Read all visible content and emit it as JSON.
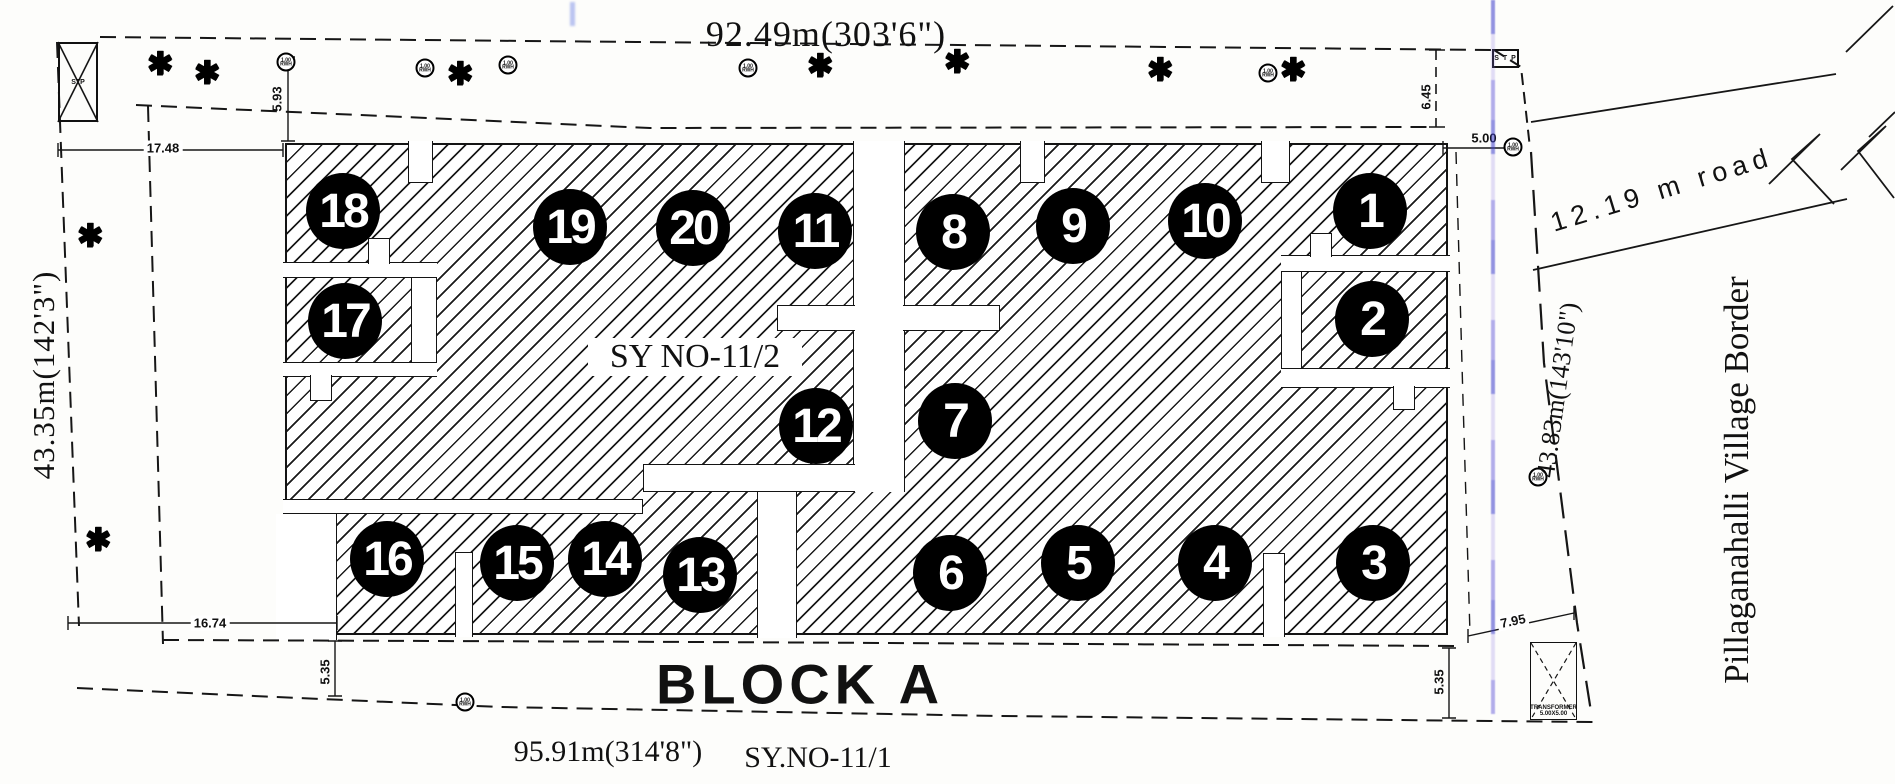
{
  "drawing": {
    "block_label": "BLOCK A",
    "survey_no_center": "SY NO-11/2",
    "survey_no_south": "SY.NO-11/1",
    "road_label": "12.19 m road",
    "village_border": "Pillaganahalli Village Border",
    "dimensions": {
      "top": "92.49m(303'6\")",
      "bottom": "95.91m(314'8\")",
      "left": "43.35m(142'3\")",
      "right": "43.83m(143'10\")",
      "offset_top_left": "17.48",
      "green_strip_top": "5.93",
      "corner_top_right": "6.45",
      "stp_gap_right": "5.00",
      "offset_bottom_left": "16.74",
      "road_bottom_left": "5.35",
      "road_bottom_right": "5.35",
      "corner_bottom_right": "7.95"
    },
    "structures": {
      "stp_main": "STP",
      "stp_small": "S T P",
      "transformer_name": "TRANSFORMER",
      "transformer_size": "5.00X5.00"
    },
    "markers": {
      "rwh_value": "1.00",
      "rwh_label": "RWH"
    },
    "icons": {
      "tree": "✱"
    },
    "plots": [
      "1",
      "2",
      "3",
      "4",
      "5",
      "6",
      "7",
      "8",
      "9",
      "10",
      "11",
      "12",
      "13",
      "14",
      "15",
      "16",
      "17",
      "18",
      "19",
      "20"
    ]
  }
}
